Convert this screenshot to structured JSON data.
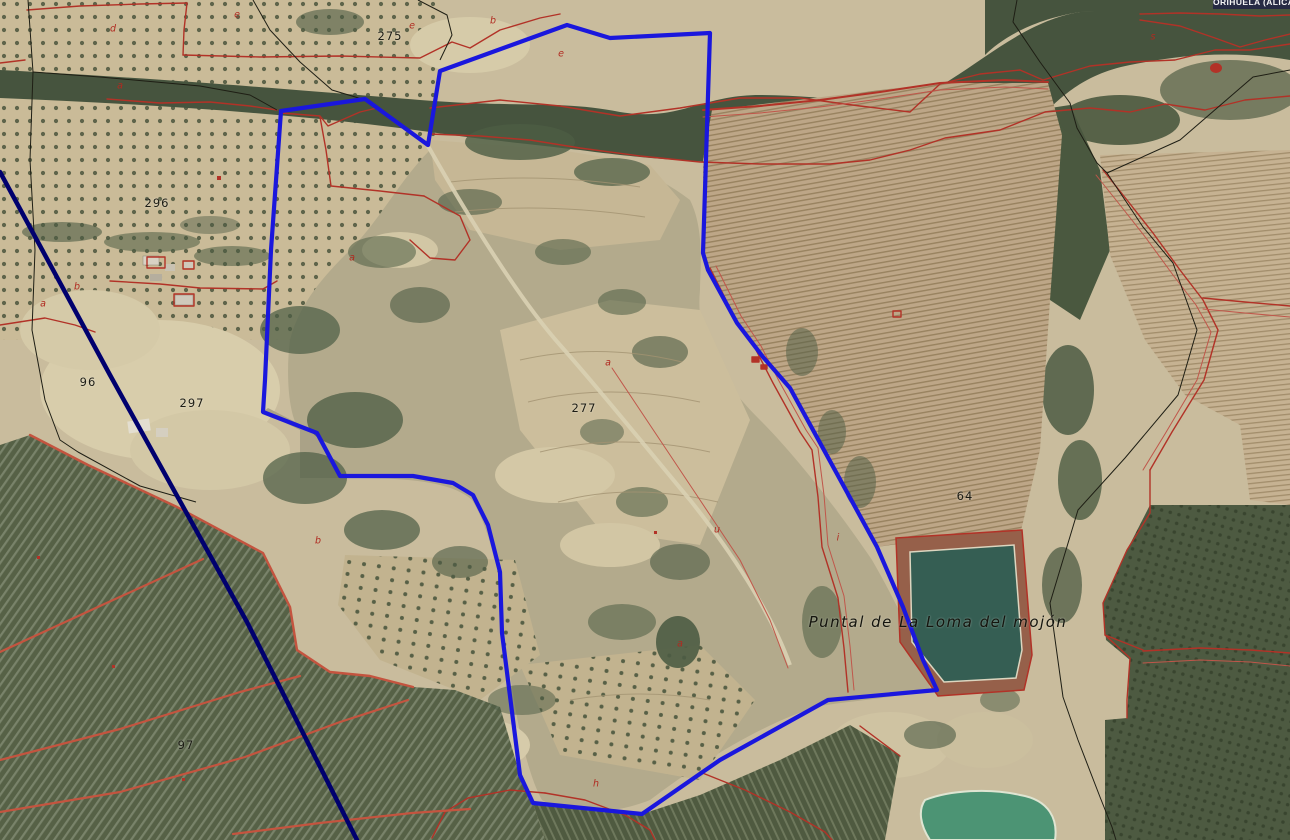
{
  "map": {
    "region_label": "ORIHUELA (ALICANTE)",
    "place_name": "Puntal de La Loma del mojón",
    "parcel_numbers": [
      {
        "text": "275"
      },
      {
        "text": "296"
      },
      {
        "text": "96"
      },
      {
        "text": "297"
      },
      {
        "text": "277"
      },
      {
        "text": "64"
      },
      {
        "text": "97"
      }
    ],
    "parcel_letters": [
      {
        "text": "d"
      },
      {
        "text": "e"
      },
      {
        "text": "a"
      },
      {
        "text": "e"
      },
      {
        "text": "b"
      },
      {
        "text": "e"
      },
      {
        "text": "a"
      },
      {
        "text": "b"
      },
      {
        "text": "a"
      },
      {
        "text": "a"
      },
      {
        "text": "u"
      },
      {
        "text": "i"
      },
      {
        "text": "b"
      },
      {
        "text": "a"
      },
      {
        "text": "h"
      },
      {
        "text": "s"
      }
    ],
    "features": {
      "selected_parcel_outline": "blue polygon boundary",
      "reservoir": "irrigation reservoir (balsa)",
      "pond": "small irrigation pond"
    },
    "colors": {
      "boundary_blue": "#1a17dd",
      "cadastral_red": "#b23227",
      "municipal_navy": "#00006e",
      "water_teal": "#355e53",
      "pond_green": "#4c9474",
      "terrain_tan": "#c9bc9d",
      "scrub_green": "#46543e"
    }
  }
}
